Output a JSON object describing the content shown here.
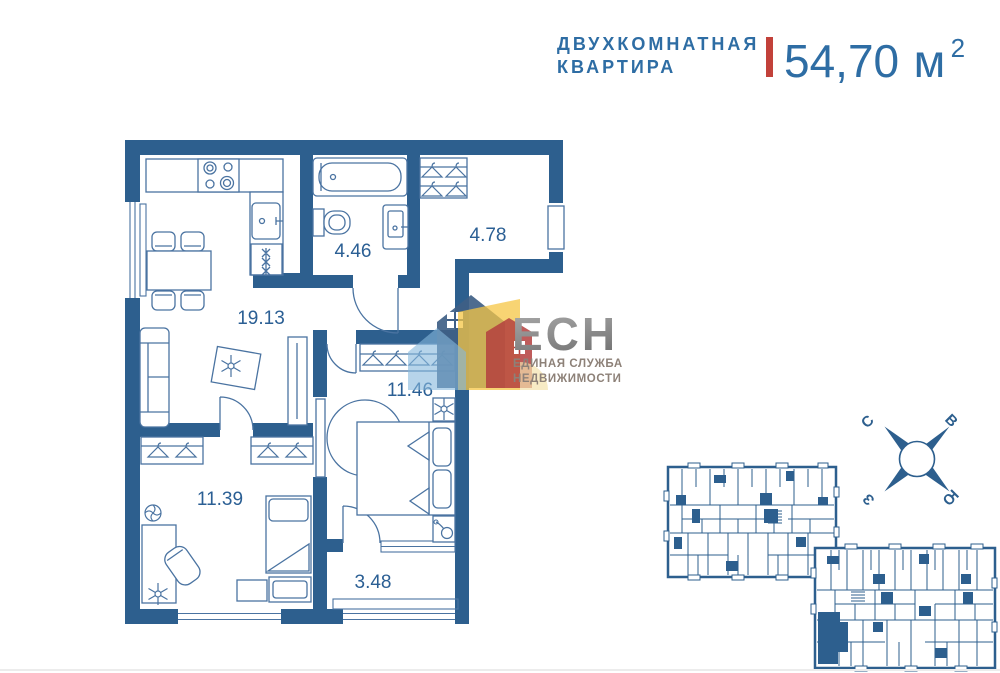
{
  "header": {
    "title_line1": "ДВУХКОМНАТНАЯ",
    "title_line2": "КВАРТИРА",
    "area_value": "54,70",
    "area_unit": "м",
    "area_sup": "2"
  },
  "logo": {
    "abbr": "ЕСН",
    "tagline_line1": "ЕДИНАЯ СЛУЖБА",
    "tagline_line2": "НЕДВИЖИМОСТИ"
  },
  "floor_plan": {
    "areas": {
      "living_kitchen": "19.13",
      "bathroom": "4.46",
      "hallway": "4.78",
      "bedroom": "11.46",
      "bedroom2": "11.39",
      "balcony": "3.48"
    }
  },
  "compass": {
    "north": "С",
    "east": "В",
    "west": "З",
    "south": "Ю"
  },
  "colors": {
    "wall_blue": "#2d5f8e",
    "fixture_blue": "#4a73a1",
    "label_blue": "#2b5f94",
    "title_blue": "#2e6da4",
    "accent_red": "#c2413a",
    "logo_gray": "#8c8c8c",
    "logo_tagline_gray": "#8d8178",
    "logo_dark_blue": "#3f5f86",
    "logo_light_blue": "#85b8dc",
    "logo_yellow": "#f6c544",
    "logo_red": "#b4403e"
  },
  "icons": {
    "hanger-icon": "outlined triangle with hook",
    "stove-icon": "four burner circles",
    "fan-icon": "circle with pinwheel blades",
    "plant-icon": "radiating leaf star",
    "hairdryer-icon": "circle with curved handle",
    "compass-rose-icon": "circle with four diagonal needles"
  }
}
